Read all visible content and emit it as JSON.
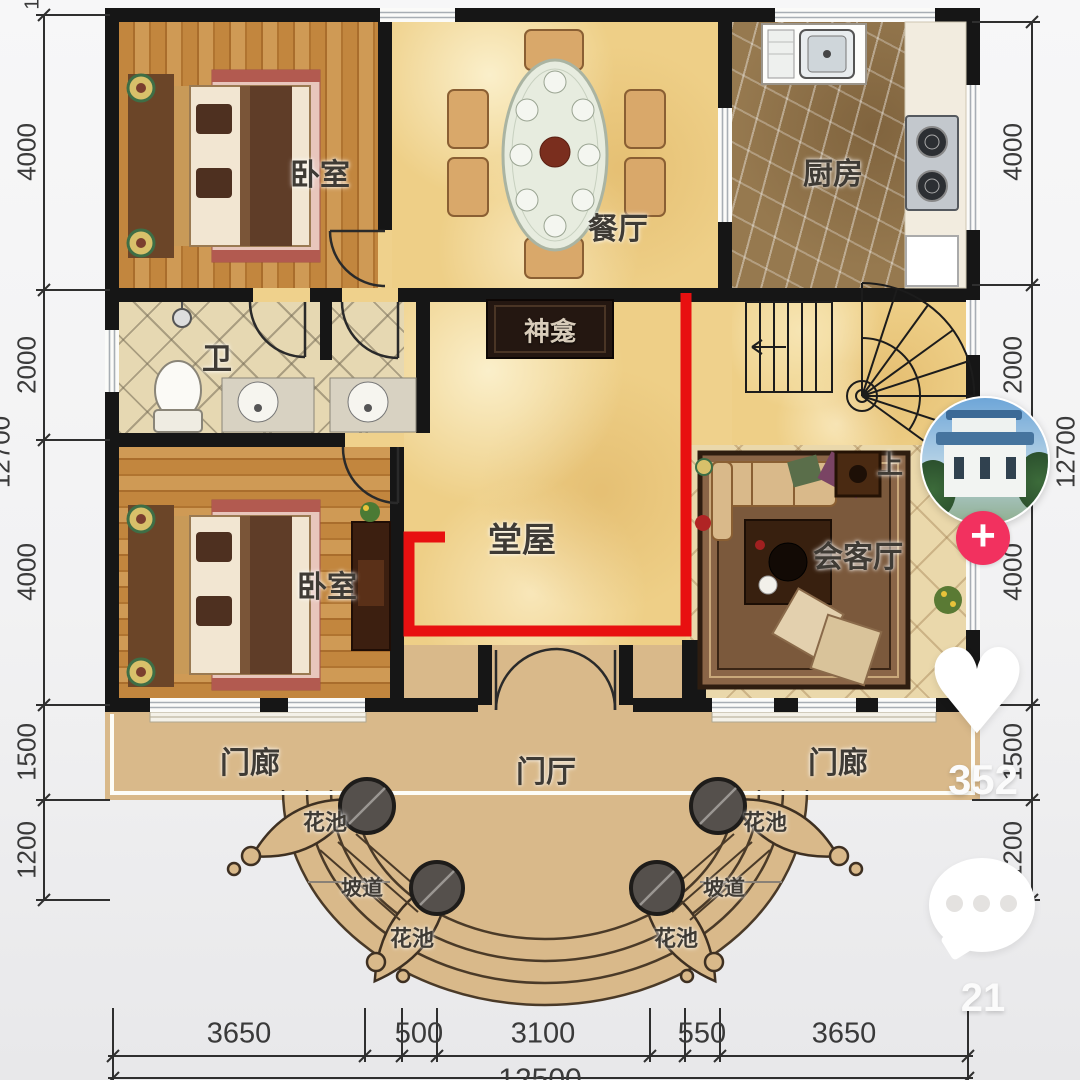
{
  "plan": {
    "rooms": {
      "bedroom": "卧室",
      "dining": "餐厅",
      "kitchen": "厨房",
      "bath": "卫",
      "shrine": "神龛",
      "hall": "堂屋",
      "living": "会客厅",
      "up": "上",
      "porch": "门廊",
      "entry_hall": "门厅",
      "flower_bed": "花池",
      "ramp": "坡道"
    },
    "dims": {
      "left": [
        "4000",
        "2000",
        "4000",
        "1500",
        "1200"
      ],
      "right": [
        "4000",
        "2000",
        "4000",
        "1500",
        "1200"
      ],
      "bottom": [
        "3650",
        "500",
        "3100",
        "550",
        "3650"
      ],
      "total_vertical": "12700",
      "total_horizontal": "12500",
      "top_partial": "1"
    }
  },
  "overlay": {
    "follow_label": "+",
    "heart_glyph": "♥",
    "like_count": "352",
    "comment_count": "21"
  },
  "colors": {
    "wall": "#161616",
    "highlight_red": "#e81010",
    "follow_pink": "#f2315f",
    "floor_yellow": "#efd18c",
    "porch_tan": "#d9b98a"
  }
}
